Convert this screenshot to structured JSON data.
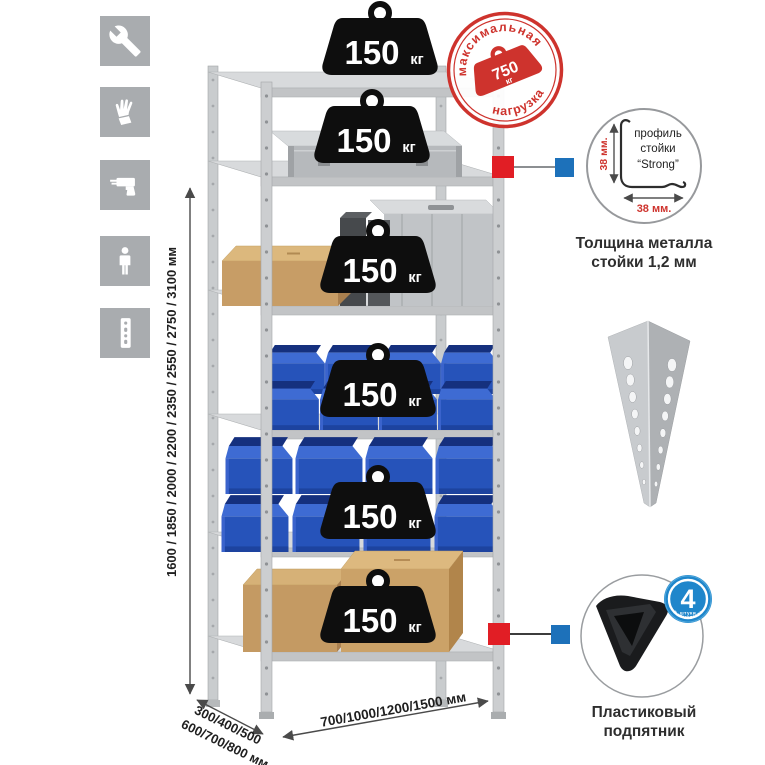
{
  "colors": {
    "accent_red": "#ce332d",
    "marker_red": "#e11e25",
    "marker_blue": "#1d71ba",
    "bin_blue": "#2653ba",
    "metal_gray": "#c6c9cb",
    "icon_bg": "#a9acaf"
  },
  "sidebar_icons": [
    {
      "name": "wrench"
    },
    {
      "name": "gloves"
    },
    {
      "name": "drill"
    },
    {
      "name": "person"
    },
    {
      "name": "perforated-profile"
    }
  ],
  "dimensions": {
    "height": "1600 / 1850 / 2000 / 2200 / 2350 / 2550 / 2750 / 3100 мм",
    "depth_line1": "300/400/500",
    "depth_line2": "600/700/800 мм",
    "width": "700/1000/1200/1500 мм"
  },
  "rack": {
    "shelf_count": 6,
    "load_value": "150",
    "load_unit": "кг",
    "load_label": "150 кг"
  },
  "stamp": {
    "arc_top": "максимальная",
    "arc_bottom": "нагрузка",
    "value": "750",
    "unit": "кг"
  },
  "profile_detail": {
    "label_line1": "профиль",
    "label_line2": "стойки",
    "label_line3": "“Strong”",
    "dim_vertical": "38 мм.",
    "dim_horizontal": "38 мм.",
    "caption_line1": "Толщина металла",
    "caption_line2": "стойки 1,2 мм"
  },
  "foot_detail": {
    "badge_count": "4",
    "badge_count_unit": "штуки",
    "badge_arc": "в комплекте",
    "caption_line1": "Пластиковый",
    "caption_line2": "подпятник"
  }
}
